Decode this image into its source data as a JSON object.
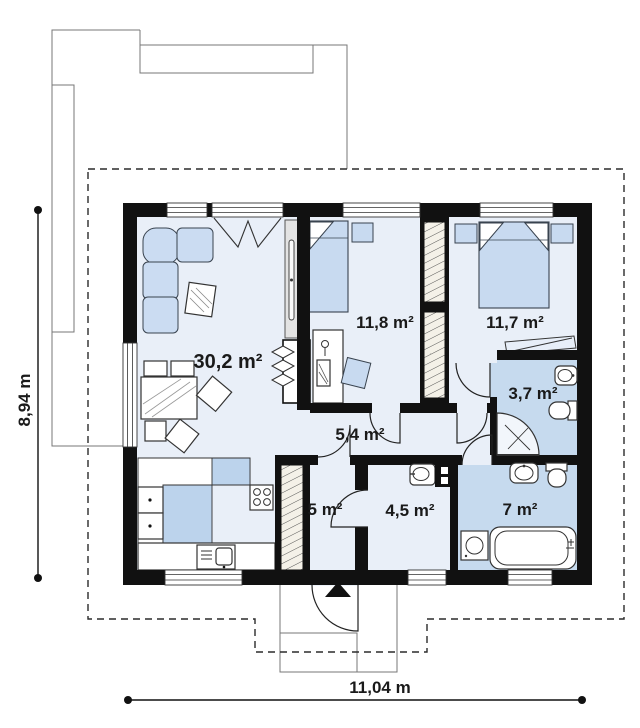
{
  "plan": {
    "type": "house-floor-plan",
    "rooms": [
      {
        "name": "living-room-kitchen",
        "area_label": "30,2 m²"
      },
      {
        "name": "bedroom-1",
        "area_label": "11,8 m²"
      },
      {
        "name": "bedroom-2",
        "area_label": "11,7 m²"
      },
      {
        "name": "hallway",
        "area_label": "5,4 m²"
      },
      {
        "name": "bathroom-small",
        "area_label": "3,7 m²"
      },
      {
        "name": "vestibule",
        "area_label": "5 m²"
      },
      {
        "name": "utility-room",
        "area_label": "4,5 m²"
      },
      {
        "name": "bathroom",
        "area_label": "7 m²"
      }
    ],
    "dimensions": {
      "height_label": "8,94 m",
      "width_label": "11,04 m"
    },
    "colors": {
      "wall": "#111111",
      "floor": "#e9eff8",
      "bath_floor": "#c6daee",
      "furniture_blue": "#c8daf0",
      "kitchen_blue": "#bcd3ec",
      "hatch_base": "#f4f1e8"
    }
  }
}
